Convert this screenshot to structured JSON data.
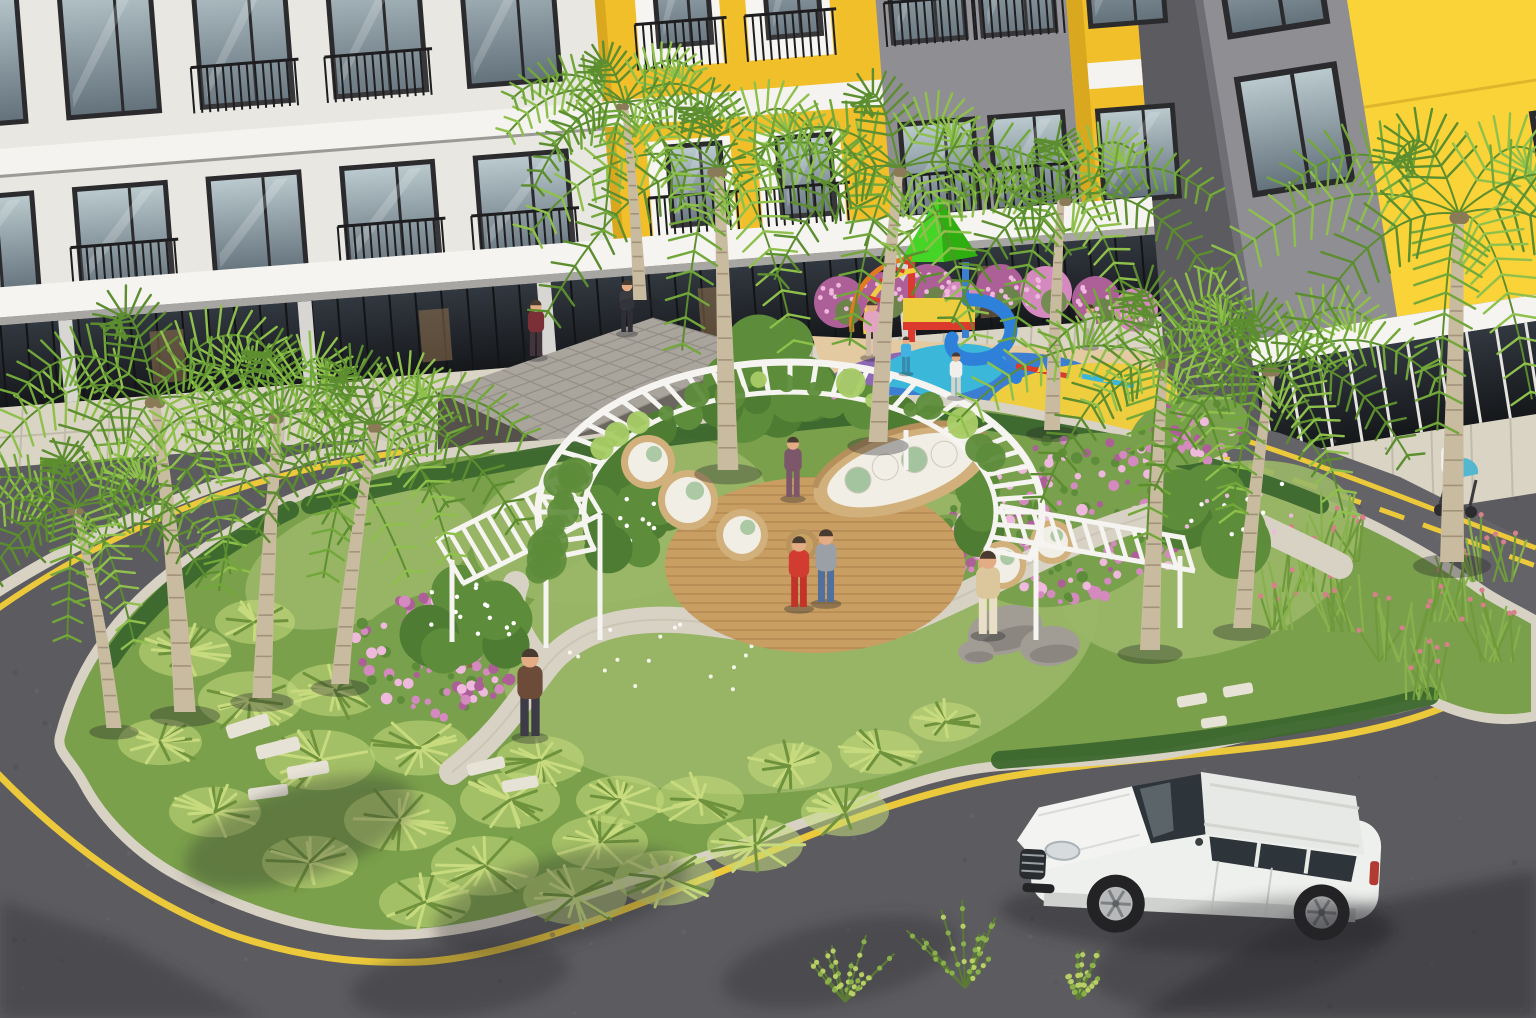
{
  "colors": {
    "asphalt": "#5c5b5f",
    "asphaltLight": "#646367",
    "roadShade": "#46454a",
    "yellowLine": "#ecc93a",
    "curb": "#d8d2c5",
    "islandBase": "#7aa04b",
    "lawn": "#9ab768",
    "fern": "#c7da7e",
    "fernDark": "#6f923c",
    "hedge": "#3c672d",
    "foliage": "#5d8c3a",
    "leafLight": "#a8cc66",
    "palmLight": "#8fc04c",
    "palmMid": "#72a73a",
    "palmDark": "#5c8d2f",
    "trunk": "#c8bb9f",
    "trunkRing": "#a2927a",
    "pink": "#d489bf",
    "pinkDark": "#ad5f98",
    "pinkLight": "#eeb9dd",
    "pergola": "#f5f4f0",
    "deck": "#c89e63",
    "deckLine": "#b08650",
    "rattan": "#d2b07c",
    "cushion": "#f1eee6",
    "pillowGreen": "#a4c49f",
    "gravel": "#d8d2c4",
    "stone": "#e7e2d6",
    "rock": "#a19d94",
    "rockDark": "#827e78",
    "wallWhite": "#e9e7e2",
    "slab": "#f4f3f0",
    "frame": "#2b2b2e",
    "railing": "#1e1e20",
    "canopyTop": "#f5f4f1",
    "canopyUnder": "#a8a6a3",
    "yellowWall": "#f1bf29",
    "yellowBright": "#fad338",
    "yellowShade": "#d9a81f",
    "grayPanel": "#8f8e93",
    "grayDark": "#55565c",
    "storeGlass": "#22262a",
    "storeFrame": "#121416",
    "interiorGlow": "#a88257",
    "boxFront": "#6b6660",
    "boxSide": "#56514c",
    "boxRoof": "#a9a59d",
    "boxGrid": "#928e86",
    "tile": "#dad4c5",
    "tileLine": "#c1bbab",
    "pgTan": "#e4caa1",
    "pgBlue": "#3c7ed2",
    "pgYellow": "#eecd3e",
    "pgPurple": "#8d68b5",
    "pgCyan": "#3bb7d9",
    "pgRed": "#dc3a2c",
    "pgGreen": "#45d527",
    "pgGreenDk": "#2fae12",
    "slideBlue": "#2f80d8",
    "pgOrange": "#e07b20",
    "suvBody": "#eef0ed",
    "suvRoof": "#e7e9e6",
    "glassDark": "#2e353a",
    "alloy": "#b8b9ba",
    "wheelDark": "#232325",
    "sedan": "#46474b",
    "sedanTop": "#2c2d31",
    "skin": "#e3ac84",
    "hair": "#4a3b30",
    "stroller": "#53b7cf",
    "shadowFill": "#26262b",
    "white": "#ffffff"
  },
  "scene": {
    "geometry": {
      "island": "M60,736 C70,698 86,664 106,638 C132,602 162,576 196,554 C226,534 258,512 298,496 C336,480 378,467 420,458 C462,449 503,448 545,445 C585,442 625,434 665,427 C705,420 748,416 790,412 C830,408 870,400 910,400 C952,400 994,405 1035,414 C1076,423 1115,430 1155,442 C1195,454 1234,466 1272,482 C1312,499 1352,514 1390,534 C1424,552 1452,569 1480,589 C1500,603 1520,611 1536,621 L1536,716 C1498,724 1464,716 1430,700 C1388,712 1344,720 1300,726 C1254,733 1206,748 1160,755 C1112,762 1050,762 1000,766 C948,770 904,786 860,802 C812,820 756,840 700,858 C640,877 558,906 498,921 C452,932 408,937 364,934 C298,929 238,907 184,879 C142,858 104,822 84,784 C70,758 56,752 60,736 Z",
      "roadUpper": "M545,420 L700,378 L860,362 L1000,372 L1140,398 L1280,433 L1400,477 L1536,545 L1536,625 L1480,589 L1390,534 L1272,482 L1155,442 L1035,414 L910,400 L790,412 L665,427 L545,445 Z",
      "yellowSweep": "M-4,772 C60,838 140,900 230,934 C300,958 360,964 420,962 C500,958 600,920 700,880 C790,845 880,800 1000,778 C1100,760 1200,756 1300,742 C1370,732 1440,716 1480,688 C1510,666 1526,650 1536,636",
      "leftCurb": "M-4,592 C70,545 150,508 230,480 C290,460 350,447 430,438",
      "leftYellow": "M-4,610 C70,558 145,521 225,493 C285,473 345,459 425,449",
      "centerDash": "M612,420 C760,398 920,396 1080,424 C1220,448 1360,502 1536,566",
      "upperSolid": "M1150,414 C1270,441 1400,498 1536,548",
      "gravel1": "M452,772 C500,735 520,700 545,668 C580,622 640,615 700,622 C780,632 850,648 920,615 C990,585 1040,555 1100,532 C1140,517 1170,510 1205,502",
      "gravel2": "M545,668 C520,640 505,612 516,584",
      "gravel3": "M1205,502 C1250,522 1300,545 1340,566",
      "hedgeTop": "M310,505 C500,455 700,430 900,412 C1050,425 1200,455 1320,505",
      "hedgeBottom": "M1000,760 C1150,748 1300,730 1430,696",
      "hedgeLeft": "M110,660 C150,600 210,550 290,510",
      "plaza": "M360,432 L560,396 L790,382 L862,422 L700,470 L468,472 Z",
      "pgPad": "M812,336 L1150,352 L1180,426 L842,430 Z"
    },
    "palms": [
      {
        "x": 185,
        "y": 712,
        "s": 1.35,
        "lean": -0.25
      },
      {
        "x": 262,
        "y": 698,
        "s": 1.22,
        "lean": 0.15
      },
      {
        "x": 340,
        "y": 684,
        "s": 1.12,
        "lean": 0.35
      },
      {
        "x": 114,
        "y": 728,
        "s": 0.95,
        "lean": -0.45
      },
      {
        "x": 728,
        "y": 470,
        "s": 1.3,
        "lean": -0.08
      },
      {
        "x": 878,
        "y": 442,
        "s": 1.18,
        "lean": 0.2
      },
      {
        "x": 1052,
        "y": 430,
        "s": 1.0,
        "lean": 0.1
      },
      {
        "x": 1150,
        "y": 650,
        "s": 1.25,
        "lean": 0.12
      },
      {
        "x": 1242,
        "y": 628,
        "s": 1.12,
        "lean": 0.3
      },
      {
        "x": 1452,
        "y": 562,
        "s": 1.5,
        "lean": 0.05
      },
      {
        "x": 640,
        "y": 300,
        "s": 0.85,
        "lean": -0.2
      }
    ],
    "people": [
      {
        "x": 536,
        "y": 356,
        "h": 54,
        "top": "#7b3038",
        "bottom": "#43333a",
        "name": "visitor-entrance-1"
      },
      {
        "x": 627,
        "y": 332,
        "h": 50,
        "top": "#3b3b42",
        "bottom": "#2e2e34",
        "name": "visitor-entrance-2"
      },
      {
        "x": 530,
        "y": 736,
        "h": 84,
        "top": "#6d4b39",
        "bottom": "#3d3b45",
        "name": "elderly-man"
      },
      {
        "x": 988,
        "y": 634,
        "h": 80,
        "top": "#dcc69c",
        "bottom": "#e8dfc6",
        "name": "man-on-path"
      },
      {
        "x": 793,
        "y": 497,
        "h": 58,
        "top": "#7c5669",
        "bottom": "#7c5669",
        "name": "woman-pergola"
      },
      {
        "x": 799,
        "y": 607,
        "h": 68,
        "top": "#d23b30",
        "bottom": "#c2332a",
        "name": "girl-red-dress"
      },
      {
        "x": 826,
        "y": 602,
        "h": 70,
        "top": "#9aa0a6",
        "bottom": "#50709f",
        "name": "boy-denim"
      },
      {
        "x": 872,
        "y": 356,
        "h": 54,
        "top": "#e2a4c0",
        "bottom": "#cdb9a6",
        "name": "mother-playground"
      },
      {
        "x": 906,
        "y": 372,
        "h": 34,
        "top": "#42b2e2",
        "bottom": "#3789ad",
        "name": "child-playground-1"
      },
      {
        "x": 956,
        "y": 396,
        "h": 42,
        "top": "#f0efec",
        "bottom": "#d8d3c8",
        "name": "child-playground-2"
      },
      {
        "x": 1090,
        "y": 346,
        "h": 40,
        "top": "#cfc8bd",
        "bottom": "#b5ab9d",
        "name": "person-seated-playground"
      },
      {
        "x": 1452,
        "y": 506,
        "h": 72,
        "top": "#f1f1ee",
        "bottom": "#3d3d42",
        "name": "stroller-parent"
      }
    ],
    "ferns": [
      [
        185,
        652,
        46
      ],
      [
        250,
        700,
        52
      ],
      [
        320,
        760,
        55
      ],
      [
        400,
        820,
        56
      ],
      [
        485,
        866,
        54
      ],
      [
        575,
        896,
        52
      ],
      [
        665,
        878,
        50
      ],
      [
        755,
        845,
        48
      ],
      [
        845,
        812,
        44
      ],
      [
        255,
        622,
        40
      ],
      [
        335,
        690,
        48
      ],
      [
        420,
        748,
        50
      ],
      [
        510,
        800,
        50
      ],
      [
        600,
        842,
        48
      ],
      [
        700,
        800,
        44
      ],
      [
        790,
        766,
        42
      ],
      [
        215,
        812,
        46
      ],
      [
        160,
        742,
        42
      ],
      [
        310,
        862,
        48
      ],
      [
        425,
        902,
        46
      ],
      [
        880,
        752,
        40
      ],
      [
        945,
        722,
        36
      ],
      [
        540,
        760,
        44
      ],
      [
        620,
        800,
        44
      ]
    ],
    "grasses": [
      [
        1300,
        592
      ],
      [
        1348,
        632
      ],
      [
        1398,
        662
      ],
      [
        1448,
        622
      ],
      [
        1490,
        582
      ],
      [
        1338,
        562
      ],
      [
        1428,
        700
      ],
      [
        1492,
        662
      ],
      [
        1272,
        630
      ]
    ],
    "lawns": [
      [
        800,
        640,
        300,
        150,
        -8
      ],
      [
        1210,
        560,
        155,
        92,
        -18
      ],
      [
        360,
        560,
        120,
        60,
        -20
      ],
      [
        620,
        520,
        150,
        80,
        -12
      ]
    ],
    "flowerPatches": [
      {
        "x": 432,
        "y": 656,
        "rx": 85,
        "ry": 62,
        "rot": -15
      },
      {
        "x": 1070,
        "y": 520,
        "rx": 120,
        "ry": 82,
        "rot": -20
      },
      {
        "x": 945,
        "y": 560,
        "rx": 60,
        "ry": 45,
        "rot": -10
      },
      {
        "x": 1190,
        "y": 430,
        "rx": 60,
        "ry": 34,
        "rot": -12
      }
    ],
    "pinkHedge": [
      [
        840,
        302,
        26
      ],
      [
        884,
        296,
        24
      ],
      [
        928,
        290,
        26
      ],
      [
        1000,
        288,
        24
      ],
      [
        1046,
        292,
        26
      ],
      [
        1096,
        300,
        24
      ],
      [
        1136,
        310,
        22
      ],
      [
        962,
        300,
        20
      ]
    ],
    "stones": [
      [
        248,
        726,
        44,
        14,
        -18
      ],
      [
        278,
        748,
        44,
        14,
        -14
      ],
      [
        308,
        770,
        42,
        13,
        -10
      ],
      [
        268,
        792,
        40,
        12,
        -8
      ],
      [
        486,
        766,
        38,
        12,
        -14
      ],
      [
        520,
        784,
        36,
        12,
        -10
      ],
      [
        1192,
        700,
        30,
        11,
        -10
      ],
      [
        1238,
        690,
        30,
        11,
        -10
      ],
      [
        1214,
        722,
        26,
        10,
        -8
      ]
    ],
    "rocks": [
      [
        1005,
        630,
        38,
        24,
        -15
      ],
      [
        1050,
        646,
        30,
        20,
        -5
      ],
      [
        976,
        652,
        18,
        12,
        0
      ]
    ],
    "floorBlobs": [
      [
        905,
        392,
        95,
        40,
        -8,
        "pgPurple"
      ],
      [
        988,
        400,
        118,
        46,
        -6,
        "pgBlue"
      ],
      [
        1082,
        402,
        96,
        38,
        -6,
        "pgYellow"
      ],
      [
        941,
        371,
        66,
        26,
        -8,
        "pgCyan"
      ],
      [
        1040,
        414,
        56,
        22,
        -6,
        "pgYellow"
      ],
      [
        868,
        412,
        60,
        24,
        -8,
        "pgBlue"
      ]
    ],
    "whiteCols": {
      "xs": [
        -50,
        84,
        218,
        352,
        486
      ],
      "balc1": [
        0,
        0,
        1,
        1,
        0
      ],
      "balc2": [
        0,
        1,
        0,
        1,
        1
      ]
    },
    "treeShadows": [
      [
        300,
        832,
        120,
        46,
        -18
      ],
      [
        560,
        900,
        130,
        44,
        -14
      ],
      [
        840,
        962,
        120,
        40,
        -12
      ],
      [
        1240,
        952,
        150,
        50,
        -10
      ],
      [
        460,
        980,
        110,
        36,
        -8
      ]
    ],
    "shrubs": [
      [
        845,
        1002,
        1.0
      ],
      [
        965,
        988,
        1.2
      ],
      [
        1078,
        1000,
        0.8
      ]
    ],
    "vehicles": {
      "suv": {
        "x": 1012,
        "y": 744,
        "rot": 3
      },
      "sedan": {
        "x": 1014,
        "y": 392,
        "rot": 4
      }
    },
    "pergola": {
      "cx": 790,
      "cy": 512,
      "rxO": 252,
      "ryO": 150,
      "rxI": 206,
      "ryI": 120,
      "a0": -18,
      "a1": 198,
      "deck": {
        "cx": 815,
        "cy": 565,
        "rx": 150,
        "ry": 88
      }
    },
    "stroller": {
      "x": 1462,
      "y": 470
    }
  }
}
